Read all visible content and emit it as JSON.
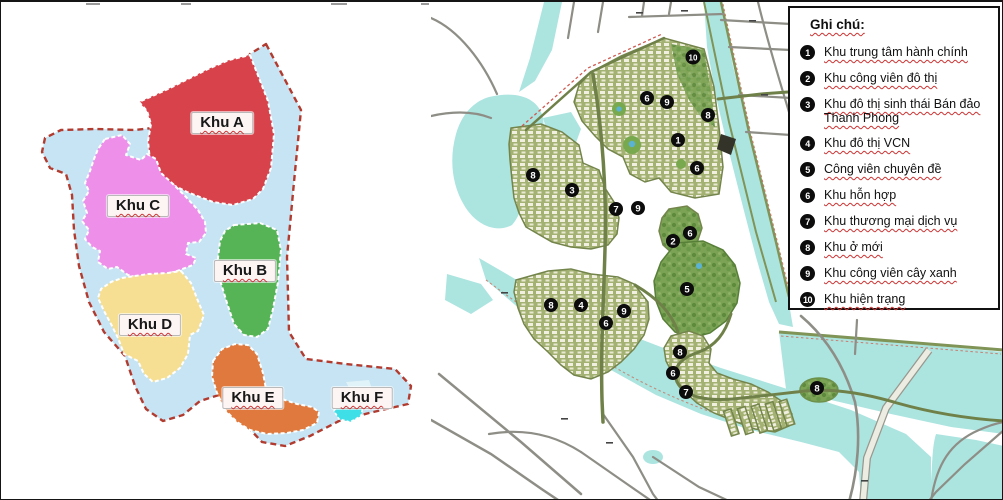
{
  "left_map": {
    "regions": [
      {
        "label": "Khu A",
        "color": "#d8434b"
      },
      {
        "label": "Khu B",
        "color": "#56b456"
      },
      {
        "label": "Khu C",
        "color": "#ee8fe9"
      },
      {
        "label": "Khu D",
        "color": "#f6df93"
      },
      {
        "label": "Khu E",
        "color": "#e0793d"
      },
      {
        "label": "Khu F",
        "color": "#3fdfe7"
      }
    ]
  },
  "right_map": {
    "markers": [
      {
        "n": "10"
      },
      {
        "n": "6"
      },
      {
        "n": "9"
      },
      {
        "n": "8"
      },
      {
        "n": "1"
      },
      {
        "n": "6"
      },
      {
        "n": "8"
      },
      {
        "n": "3"
      },
      {
        "n": "7"
      },
      {
        "n": "9"
      },
      {
        "n": "6"
      },
      {
        "n": "2"
      },
      {
        "n": "5"
      },
      {
        "n": "8"
      },
      {
        "n": "4"
      },
      {
        "n": "9"
      },
      {
        "n": "6"
      },
      {
        "n": "8"
      },
      {
        "n": "6"
      },
      {
        "n": "7"
      },
      {
        "n": "8"
      }
    ]
  },
  "legend": {
    "title": "Ghi chú:",
    "items": [
      {
        "num": "1",
        "label": "Khu trung tâm hành chính"
      },
      {
        "num": "2",
        "label": "Khu công viên đô thị"
      },
      {
        "num": "3",
        "label": "Khu đô thị sinh thái Bán đảo Thanh Phong"
      },
      {
        "num": "4",
        "label": "Khu đô thị VCN"
      },
      {
        "num": "5",
        "label": "Công viên chuyên đề"
      },
      {
        "num": "6",
        "label": "Khu hỗn hợp"
      },
      {
        "num": "7",
        "label": "Khu thương mại dịch vụ"
      },
      {
        "num": "8",
        "label": "Khu ở mới"
      },
      {
        "num": "9",
        "label": "Khu công viên cây xanh"
      },
      {
        "num": "10",
        "label": "Khu hiện trạng"
      }
    ]
  },
  "colors": {
    "water_left": "#c6e4f3",
    "boundary": "#b23b30",
    "water_right": "#ace4e0",
    "road_gray": "#8e8e86",
    "road_olive": "#6f8148"
  }
}
